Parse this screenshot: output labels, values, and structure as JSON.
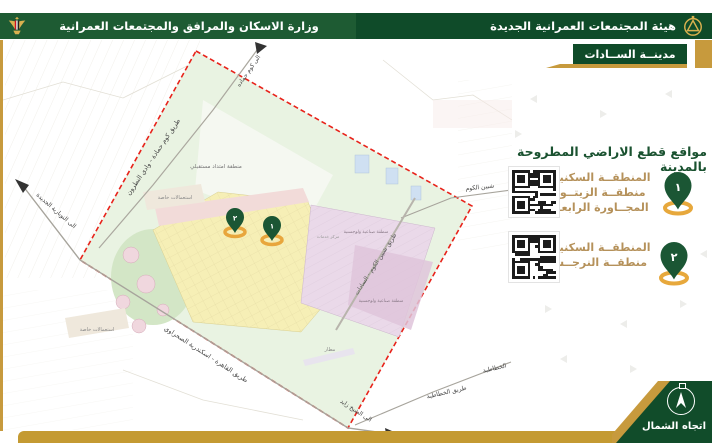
{
  "header": {
    "ministry": "وزارة الاسكان والمرافق والمجتمعات العمرانية",
    "authority": "هيئة المجتمعات العمرانية الجديدة",
    "city_badge": "مدينــة الســادات"
  },
  "panel": {
    "heading": "مواقع قطع الاراضي المطروحة بالمدينة",
    "items": [
      {
        "pin_number": "١",
        "lines": [
          "المنطقــة السكنيــة",
          "منطقــة الزيتــون",
          "المجــاورة الرابعــة"
        ]
      },
      {
        "pin_number": "٢",
        "lines": [
          "المنطقــة السكنيــة",
          "منطقــة النرجــس"
        ]
      }
    ],
    "north_label": "اتجاه الشمال"
  },
  "map": {
    "pins": [
      {
        "number": "١"
      },
      {
        "number": "٢"
      }
    ],
    "labels": {
      "road_kom_hamada": "طريق كوم حمادة - وادي النطرون",
      "to_kom_hamada": "الى كوم حماده",
      "to_nubaria": "الى النوبارية الجديدة",
      "shibin_elkom": "شبين الكوم",
      "road_shibin_sadat": "طريق شبين الكوم - السادات",
      "road_cairo_alex": "طريق القاهرة - اسكندرية الصحراوي",
      "to_sheikh_zayed": "الى الشيخ زايد",
      "road_khatatba": "طريق الخطاطبة",
      "khatatba": "الخطاطبة",
      "future_extension": "منطقة امتداد مستقبلي",
      "special_uses": "استعمالات خاصة",
      "industrial": "منطقة صناعية ولوجستية",
      "services_center": "مركز خدمات",
      "airport": "مطار"
    }
  },
  "colors": {
    "header_green": "#1e5b33",
    "dark_green": "#0f4b29",
    "gold": "#c79a3d",
    "text_gold": "#b5915a",
    "pin_green": "#1b5634",
    "boundary_red": "#e8221a"
  }
}
